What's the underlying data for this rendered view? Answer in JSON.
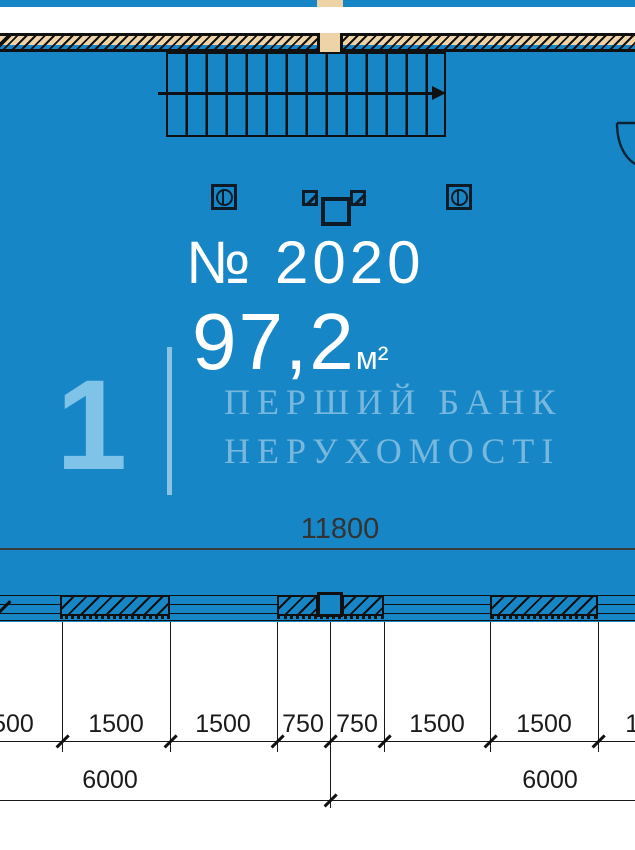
{
  "plan": {
    "unit_number": "№ 2020",
    "area_value": "97,2",
    "area_unit": "м²",
    "floor_index": "1",
    "watermark_line1": "ПЕРШИЙ БАНК",
    "watermark_line2": "НЕРУХОМОСТІ"
  },
  "dimensions": {
    "total_width": "11800",
    "row1": [
      "1500",
      "1500",
      "1500",
      "750",
      "750",
      "1500",
      "1500",
      "1500"
    ],
    "row2": [
      "6000",
      "6000"
    ]
  },
  "colors": {
    "plan_blue": "#1786c6",
    "wall_tan": "#edd3a6",
    "accent_light_blue": "#7fc3e8",
    "line_black": "#101010"
  }
}
